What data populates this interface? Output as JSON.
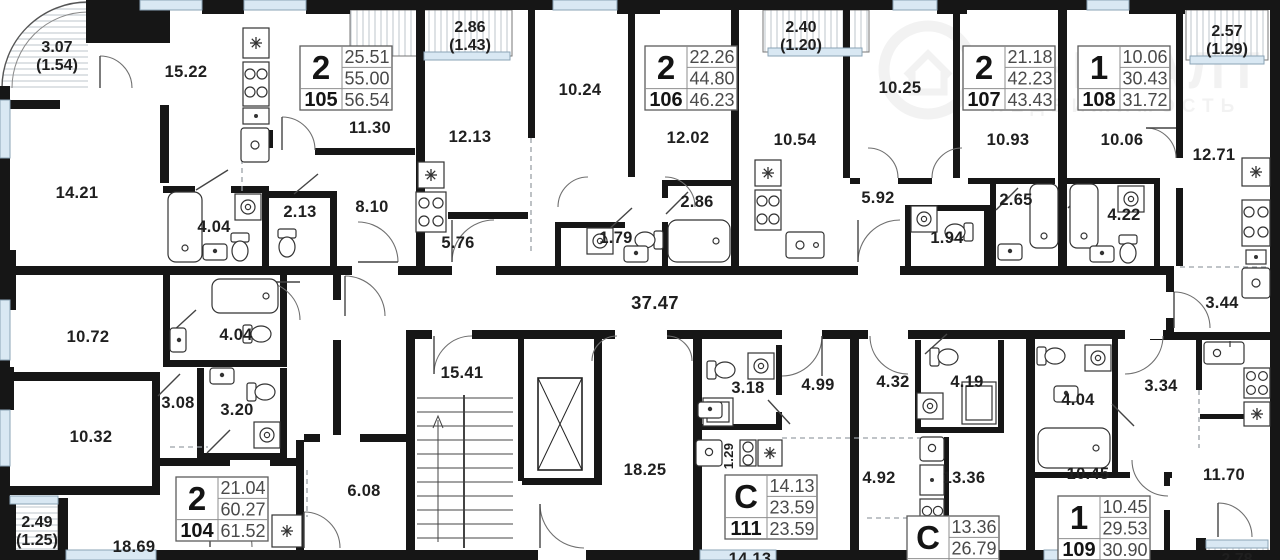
{
  "colors": {
    "wall": "#161616",
    "window_fill": "#d9e8f3",
    "window_edge": "#8aa3b6",
    "hatch": "#c7cdd3",
    "fixture_line": "#333333",
    "door_arc": "#6f6f6f",
    "dash": "#9aa0a6",
    "label": "#1f1f1f",
    "card_border": "#5c5c5c",
    "card_text": "#4a4a4a"
  },
  "watermark": {
    "brand": "ОНРЕАЛТ",
    "tagline": "НЕДВИЖИМОСТЬ"
  },
  "apartment_cards": [
    {
      "number": "105",
      "rooms": "2",
      "living_area": "25.51",
      "area": "55.00",
      "total_area": "56.54",
      "x": 300,
      "y": 46
    },
    {
      "number": "106",
      "rooms": "2",
      "living_area": "22.26",
      "area": "44.80",
      "total_area": "46.23",
      "x": 645,
      "y": 46
    },
    {
      "number": "107",
      "rooms": "2",
      "living_area": "21.18",
      "area": "42.23",
      "total_area": "43.43",
      "x": 963,
      "y": 46
    },
    {
      "number": "108",
      "rooms": "1",
      "living_area": "10.06",
      "area": "30.43",
      "total_area": "31.72",
      "x": 1078,
      "y": 46
    },
    {
      "number": "104",
      "rooms": "2",
      "living_area": "21.04",
      "area": "60.27",
      "total_area": "61.52",
      "x": 176,
      "y": 477
    },
    {
      "number": "111",
      "rooms": "С",
      "living_area": "14.13",
      "area": "23.59",
      "total_area": "23.59",
      "x": 725,
      "y": 475
    },
    {
      "number": "109",
      "rooms": "1",
      "living_area": "10.45",
      "area": "29.53",
      "total_area": "30.90",
      "x": 1058,
      "y": 496
    },
    {
      "number": "",
      "rooms": "С",
      "living_area": "13.36",
      "area": "26.79",
      "total_area": "",
      "x": 907,
      "y": 516
    }
  ],
  "room_labels": [
    {
      "text": "15.22",
      "x": 186,
      "y": 77
    },
    {
      "text": "11.30",
      "x": 370,
      "y": 133
    },
    {
      "text": "14.21",
      "x": 77,
      "y": 198
    },
    {
      "text": "4.04",
      "x": 214,
      "y": 232
    },
    {
      "text": "2.13",
      "x": 300,
      "y": 217
    },
    {
      "text": "8.10",
      "x": 372,
      "y": 212
    },
    {
      "text": "12.13",
      "x": 470,
      "y": 142
    },
    {
      "text": "10.24",
      "x": 580,
      "y": 95
    },
    {
      "text": "12.02",
      "x": 688,
      "y": 143
    },
    {
      "text": "5.76",
      "x": 458,
      "y": 248
    },
    {
      "text": "1.79",
      "x": 616,
      "y": 243
    },
    {
      "text": "2.86",
      "x": 697,
      "y": 207
    },
    {
      "text": "10.54",
      "x": 795,
      "y": 145
    },
    {
      "text": "10.25",
      "x": 900,
      "y": 93
    },
    {
      "text": "10.93",
      "x": 1008,
      "y": 145
    },
    {
      "text": "5.92",
      "x": 878,
      "y": 203
    },
    {
      "text": "1.94",
      "x": 947,
      "y": 243
    },
    {
      "text": "2.65",
      "x": 1016,
      "y": 205
    },
    {
      "text": "10.06",
      "x": 1122,
      "y": 145
    },
    {
      "text": "4.22",
      "x": 1124,
      "y": 220
    },
    {
      "text": "12.71",
      "x": 1214,
      "y": 160
    },
    {
      "text": "3.44",
      "x": 1222,
      "y": 308
    },
    {
      "text": "37.47",
      "x": 655,
      "y": 309,
      "big": true
    },
    {
      "text": "10.72",
      "x": 88,
      "y": 342
    },
    {
      "text": "4.04",
      "x": 236,
      "y": 340
    },
    {
      "text": "10.32",
      "x": 91,
      "y": 442
    },
    {
      "text": "3.08",
      "x": 178,
      "y": 408
    },
    {
      "text": "3.20",
      "x": 237,
      "y": 415
    },
    {
      "text": "15.41",
      "x": 462,
      "y": 378
    },
    {
      "text": "18.25",
      "x": 645,
      "y": 475
    },
    {
      "text": "6.08",
      "x": 364,
      "y": 496
    },
    {
      "text": "18.69",
      "x": 134,
      "y": 552
    },
    {
      "text": "3.18",
      "x": 748,
      "y": 393
    },
    {
      "text": "4.99",
      "x": 818,
      "y": 390
    },
    {
      "text": "1.29",
      "x": 733,
      "y": 456,
      "rotate": -90,
      "small": true
    },
    {
      "text": "14.13",
      "x": 750,
      "y": 564
    },
    {
      "text": "4.32",
      "x": 893,
      "y": 387
    },
    {
      "text": "4.19",
      "x": 967,
      "y": 387
    },
    {
      "text": "4.92",
      "x": 879,
      "y": 483
    },
    {
      "text": "13.36",
      "x": 964,
      "y": 483
    },
    {
      "text": "4.04",
      "x": 1078,
      "y": 405
    },
    {
      "text": "3.34",
      "x": 1161,
      "y": 391
    },
    {
      "text": "10.45",
      "x": 1088,
      "y": 479
    },
    {
      "text": "11.70",
      "x": 1224,
      "y": 480
    }
  ],
  "balcony_labels": [
    {
      "value": "3.07",
      "coef": "(1.54)",
      "x": 57,
      "y": 52
    },
    {
      "value": "2.86",
      "coef": "(1.43)",
      "x": 470,
      "y": 32
    },
    {
      "value": "2.40",
      "coef": "(1.20)",
      "x": 801,
      "y": 32
    },
    {
      "value": "2.57",
      "coef": "(1.29)",
      "x": 1227,
      "y": 36
    },
    {
      "value": "2.49",
      "coef": "(1.25)",
      "x": 37,
      "y": 527
    },
    {
      "value": "2.78",
      "coef": "",
      "x": 1237,
      "y": 564
    }
  ]
}
